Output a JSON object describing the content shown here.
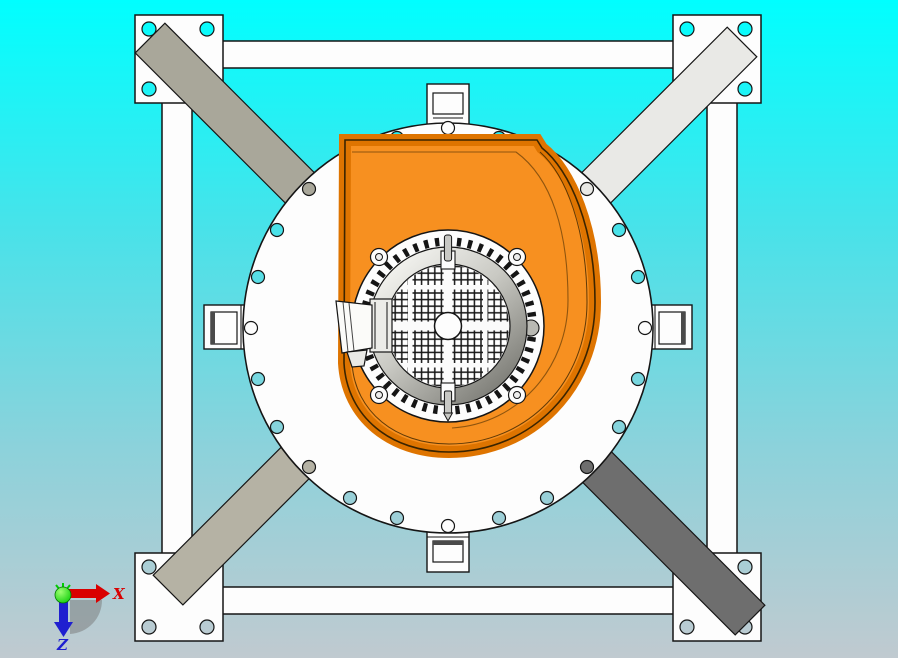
{
  "viewport": {
    "width": 898,
    "height": 658,
    "bg_top": "#00ffff",
    "bg_mid": "#49e2e9",
    "bg_low": "#8cd2db",
    "bg_bottom": "#c0cad0"
  },
  "palette": {
    "part_white": "#fdfdfd",
    "outline": "#151515",
    "volute_orange": "#f79020",
    "volute_rim": "#de7400",
    "volute_edge": "#3a2400",
    "brace_tl": "#a9a79a",
    "brace_tr": "#e9e9e6",
    "brace_bl": "#b5b2a4",
    "brace_br": "#6e6e6e",
    "motor_ring_light": "#f0f0ec",
    "motor_ring_dark": "#80807a",
    "pin_gray": "#c8c8c4",
    "mesh_line": "#161616",
    "axis_x_color": "#d90000",
    "axis_z_color": "#1f1fd0",
    "axis_origin_color": "#00c800"
  },
  "triad": {
    "x_label": "X",
    "z_label": "Z"
  }
}
